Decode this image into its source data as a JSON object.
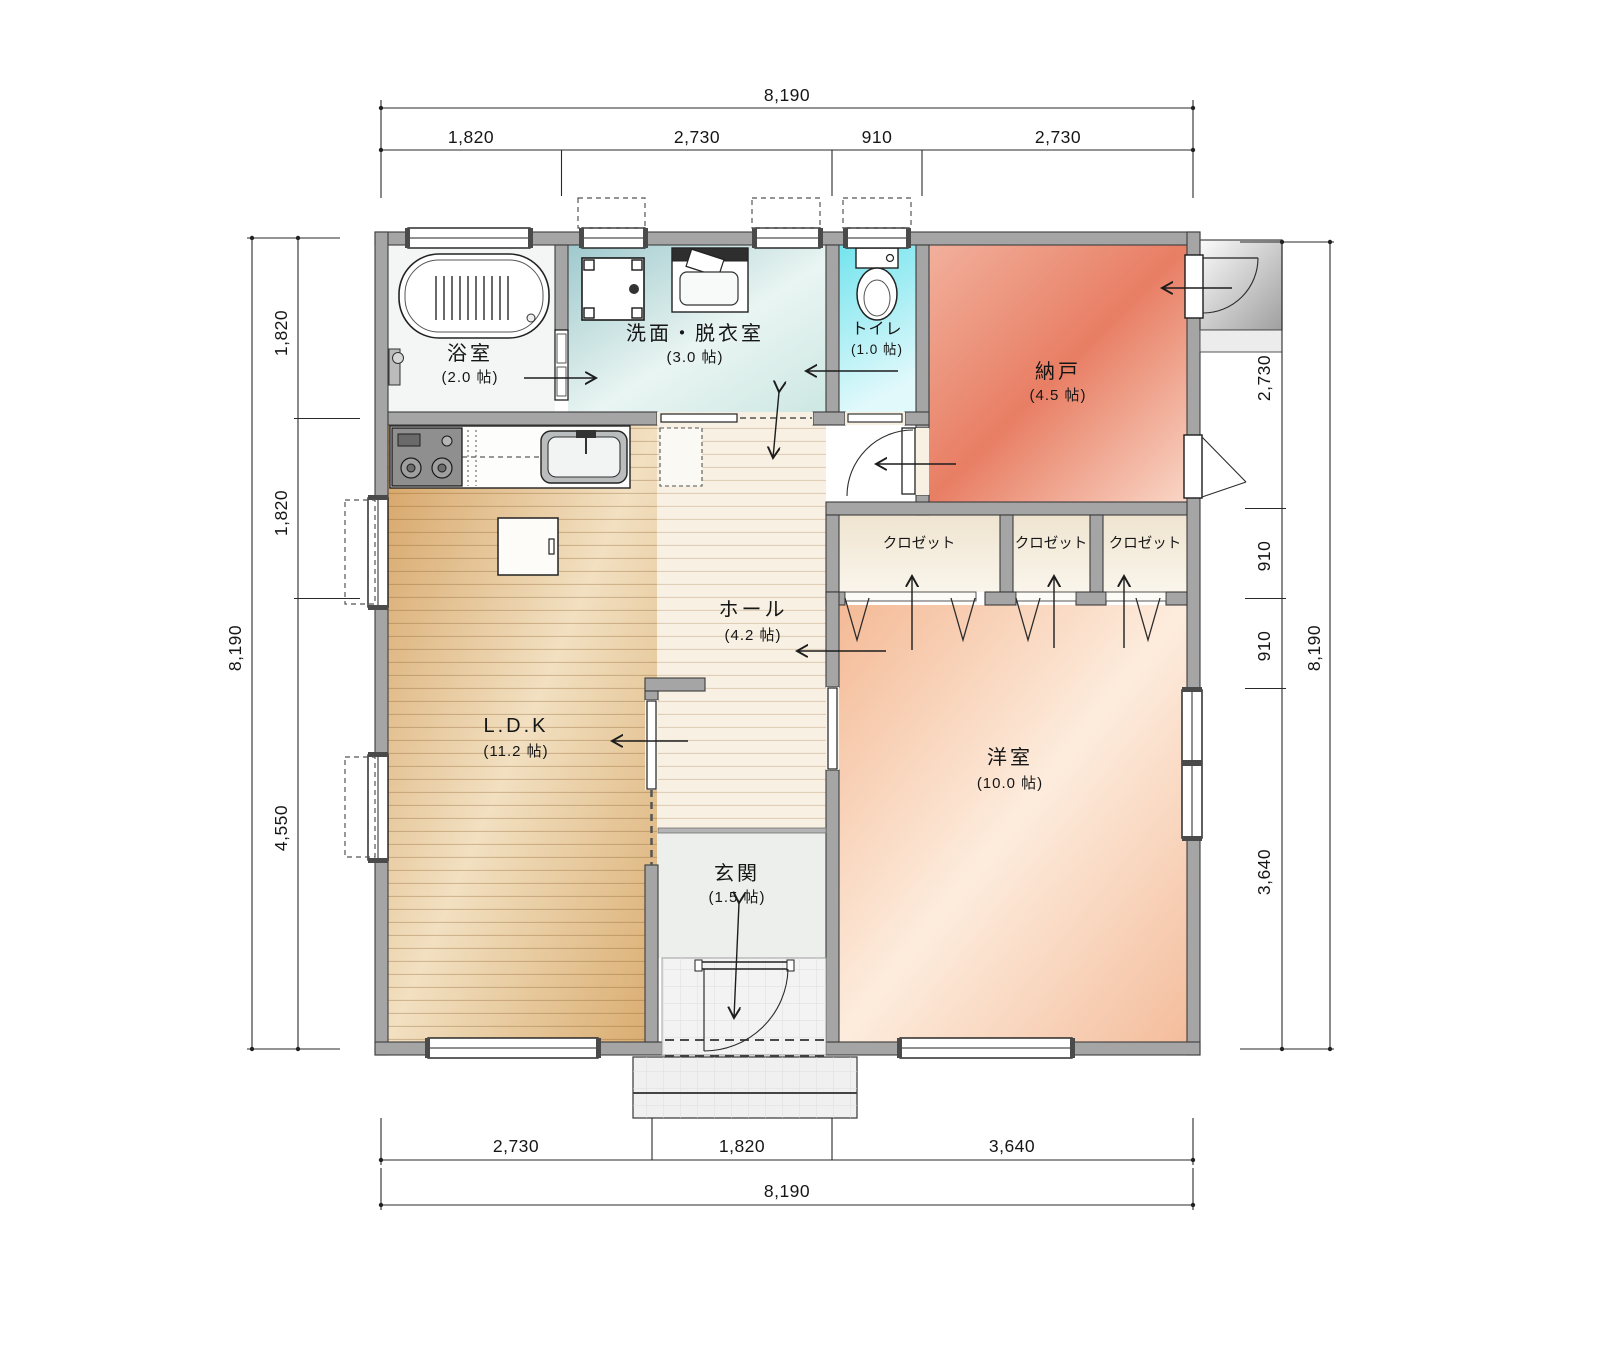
{
  "drawing": {
    "type": "floor-plan",
    "dims": {
      "top": {
        "total": "8,190",
        "segs": [
          "1,820",
          "2,730",
          "910",
          "2,730"
        ]
      },
      "bottom": {
        "total": "8,190",
        "segs": [
          "2,730",
          "1,820",
          "3,640"
        ]
      },
      "left": {
        "total": "8,190",
        "segs": [
          "1,820",
          "1,820",
          "4,550"
        ]
      },
      "right": {
        "total": "8,190",
        "segs": [
          "2,730",
          "910",
          "910",
          "3,640"
        ]
      }
    },
    "rooms": {
      "bath": {
        "name": "浴室",
        "size": "(2.0 帖)"
      },
      "washroom": {
        "name": "洗面・脱衣室",
        "size": "(3.0 帖)"
      },
      "toilet": {
        "name": "トイレ",
        "size": "(1.0 帖)"
      },
      "storage": {
        "name": "納戸",
        "size": "(4.5 帖)"
      },
      "closet": {
        "name": "クロゼット"
      },
      "hall": {
        "name": "ホール",
        "size": "(4.2 帖)"
      },
      "ldk": {
        "name": "L.D.K",
        "size": "(11.2 帖)"
      },
      "entrance": {
        "name": "玄関",
        "size": "(1.5 帖)"
      },
      "western": {
        "name": "洋室",
        "size": "(10.0 帖)"
      }
    },
    "palette": {
      "wall": "#a5a5a5",
      "ldk_wood": "#dcae74",
      "hall": "#f7f0e3",
      "washroom": "#bcdcdc",
      "toilet": "#74e4ee",
      "storage": "#e87e64",
      "western": "#f6c3a2",
      "closet": "#f2e8d6",
      "line": "#222222"
    }
  }
}
